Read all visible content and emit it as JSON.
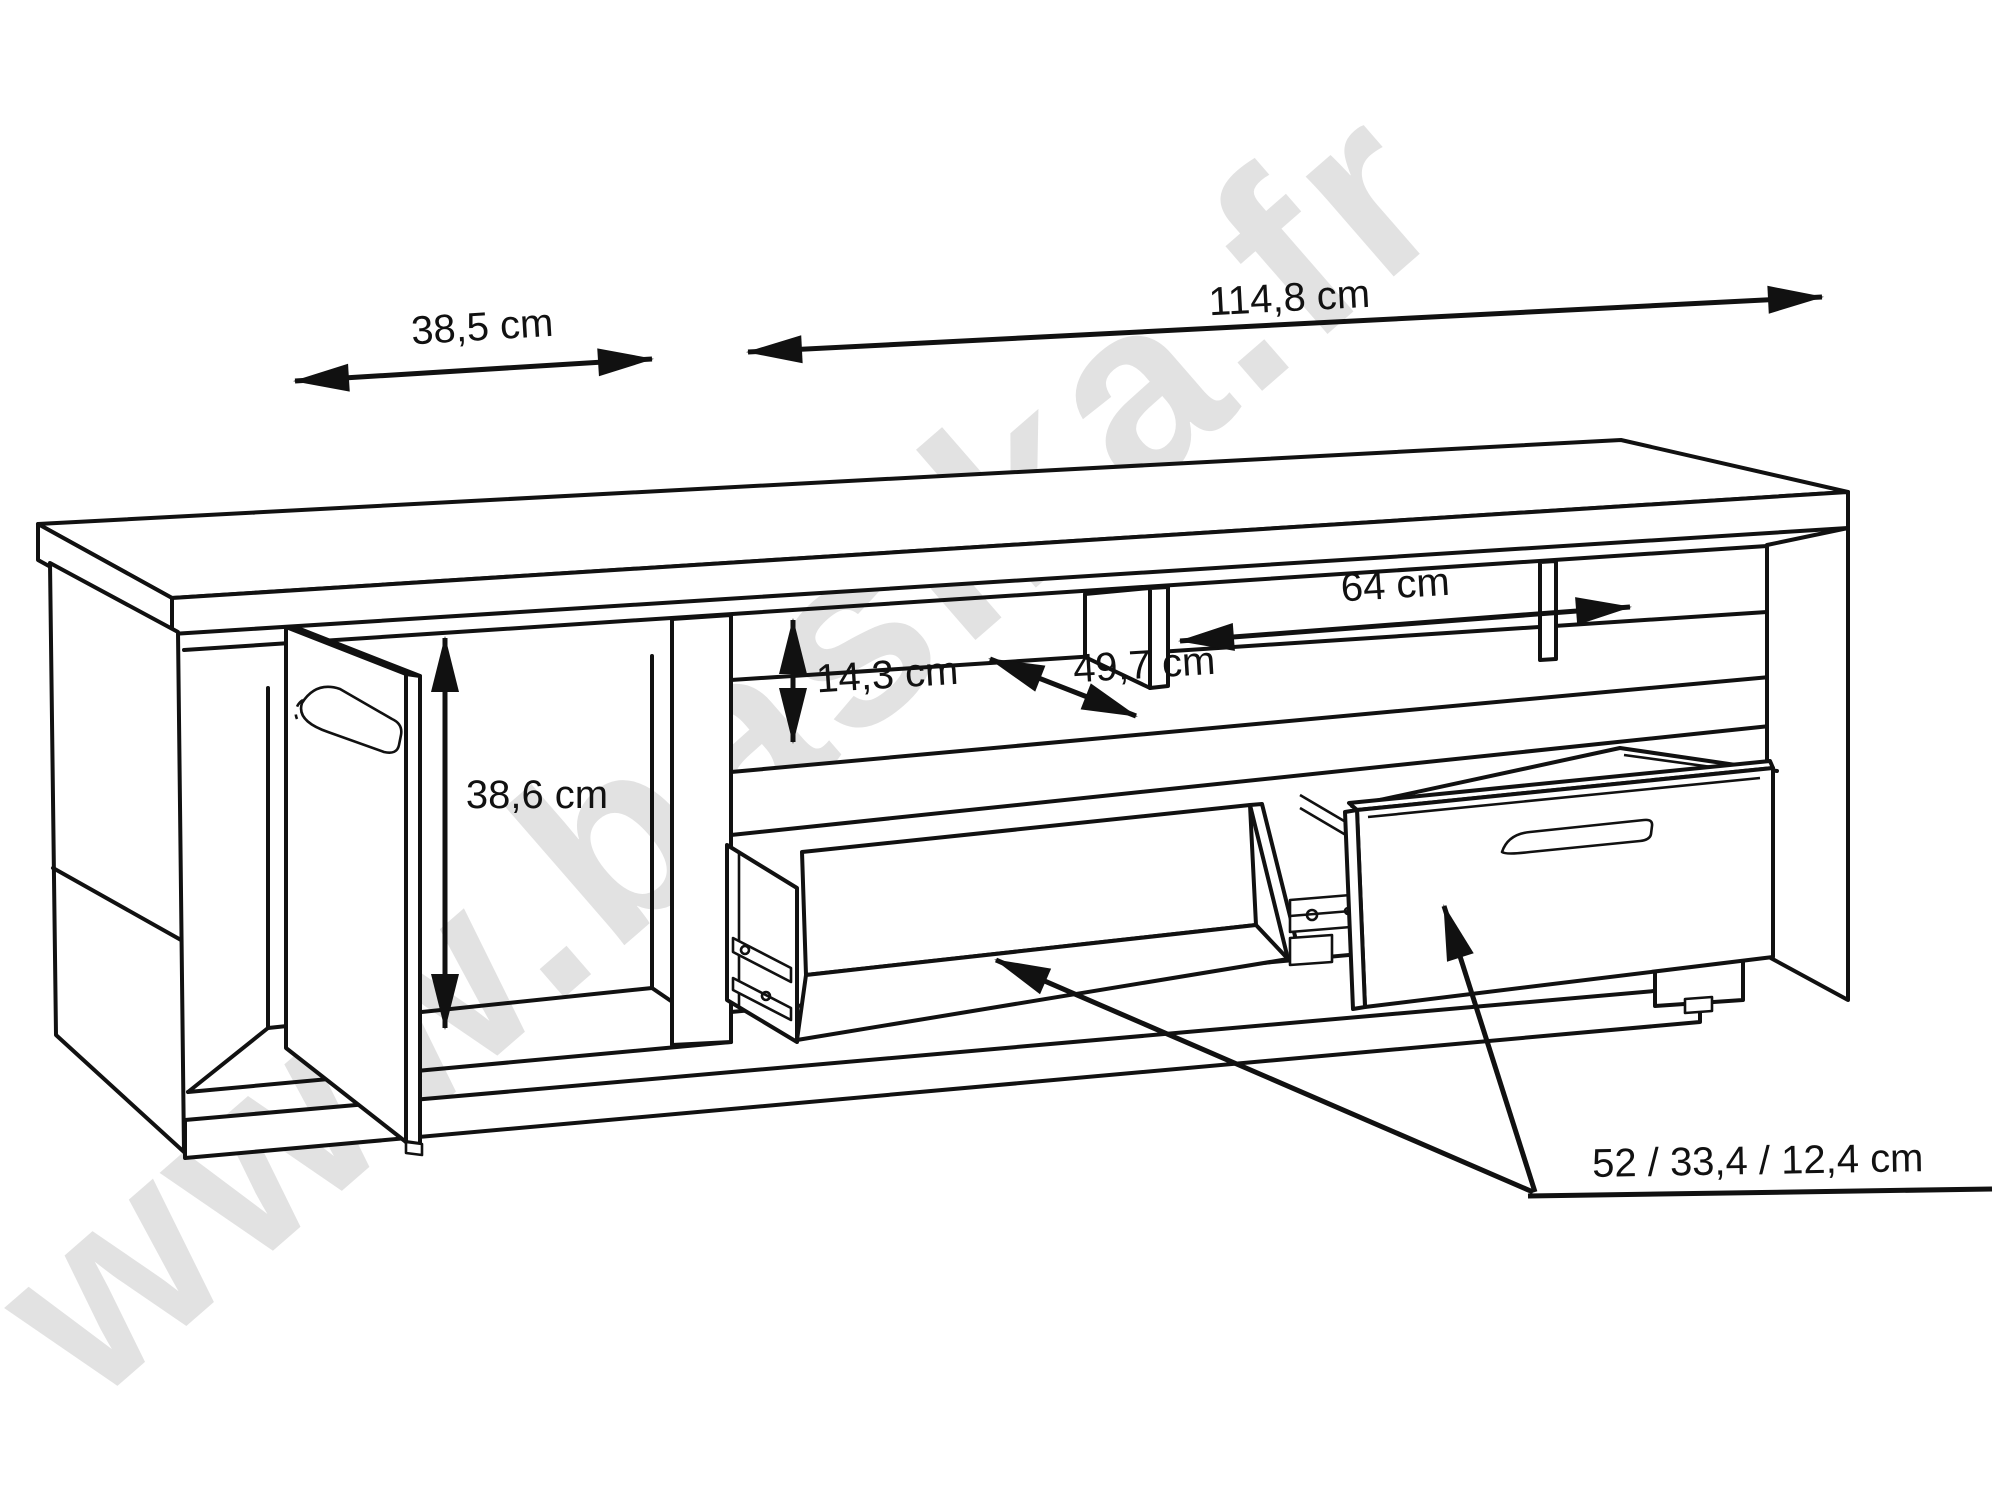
{
  "watermark": {
    "text": "www.basika.fr"
  },
  "dimensions": {
    "top_depth": {
      "label": "38,5 cm"
    },
    "top_width": {
      "label": "114,8 cm"
    },
    "shelf_width": {
      "label": "64 cm"
    },
    "shelf_height": {
      "label": "14,3 cm"
    },
    "shelf_depth": {
      "label": "49,7 cm"
    },
    "door_compartment_height": {
      "label": "38,6 cm"
    },
    "drawer_size": {
      "label": "52 / 33,4 / 12,4 cm"
    }
  }
}
